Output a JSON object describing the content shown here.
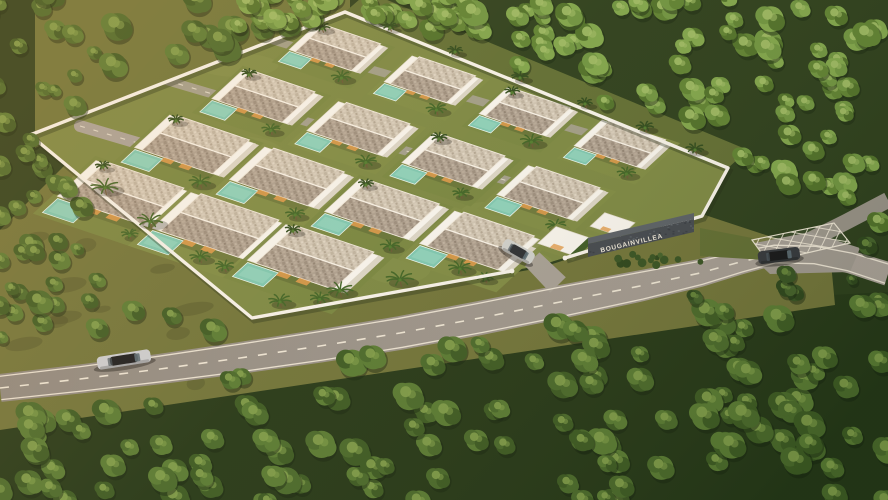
{
  "scene": {
    "type": "3d-aerial-architectural-render",
    "setting": "tropical villa development in dense forest at golden hour",
    "development": {
      "sign_text": "BOUGAINVILLEA",
      "villa_rows": 4,
      "villas_per_row": [
        4,
        4,
        4,
        3
      ],
      "entrance_flat_units": 2,
      "features": [
        "private pool per villa",
        "palm trees",
        "white perimeter wall",
        "speckled gable roofs",
        "internal lanes with dashed markings",
        "dark stone entrance sign wall"
      ]
    },
    "roads": {
      "main_road_markings": [
        "solid white edge lines",
        "dashed white center line",
        "hatched junction box"
      ],
      "vehicles": [
        {
          "name": "silver-sedan-on-road",
          "body_color": "#c9ccd1",
          "roof_color": "#1a1c1f"
        },
        {
          "name": "dark-car-at-junction",
          "body_color": "#33373d",
          "roof_color": "#15171a"
        },
        {
          "name": "silver-car-on-driveway",
          "body_color": "#cdcfcc",
          "roof_color": "#2a2e33"
        }
      ]
    },
    "colors": {
      "forest_dark": "#2c451c",
      "forest_mid": "#49692b",
      "forest_bright": "#6d9340",
      "canopy_highlight": "#9cb964",
      "grass_sunlit": "#6f7339",
      "lawn": "#7a8743",
      "asphalt": "#98928a",
      "road_marking": "#efe8d8",
      "villa_wall": "#f5f3ed",
      "roof_light": "#cdc3b2",
      "roof_dark": "#ab9e8f",
      "pool": "#7cc6b0",
      "window_glow": "#e09a4a",
      "sign_wall": "#42484f",
      "sign_text_color": "#eae5d8",
      "palm": "#2e4a1d",
      "trunk": "#6b5536"
    }
  }
}
